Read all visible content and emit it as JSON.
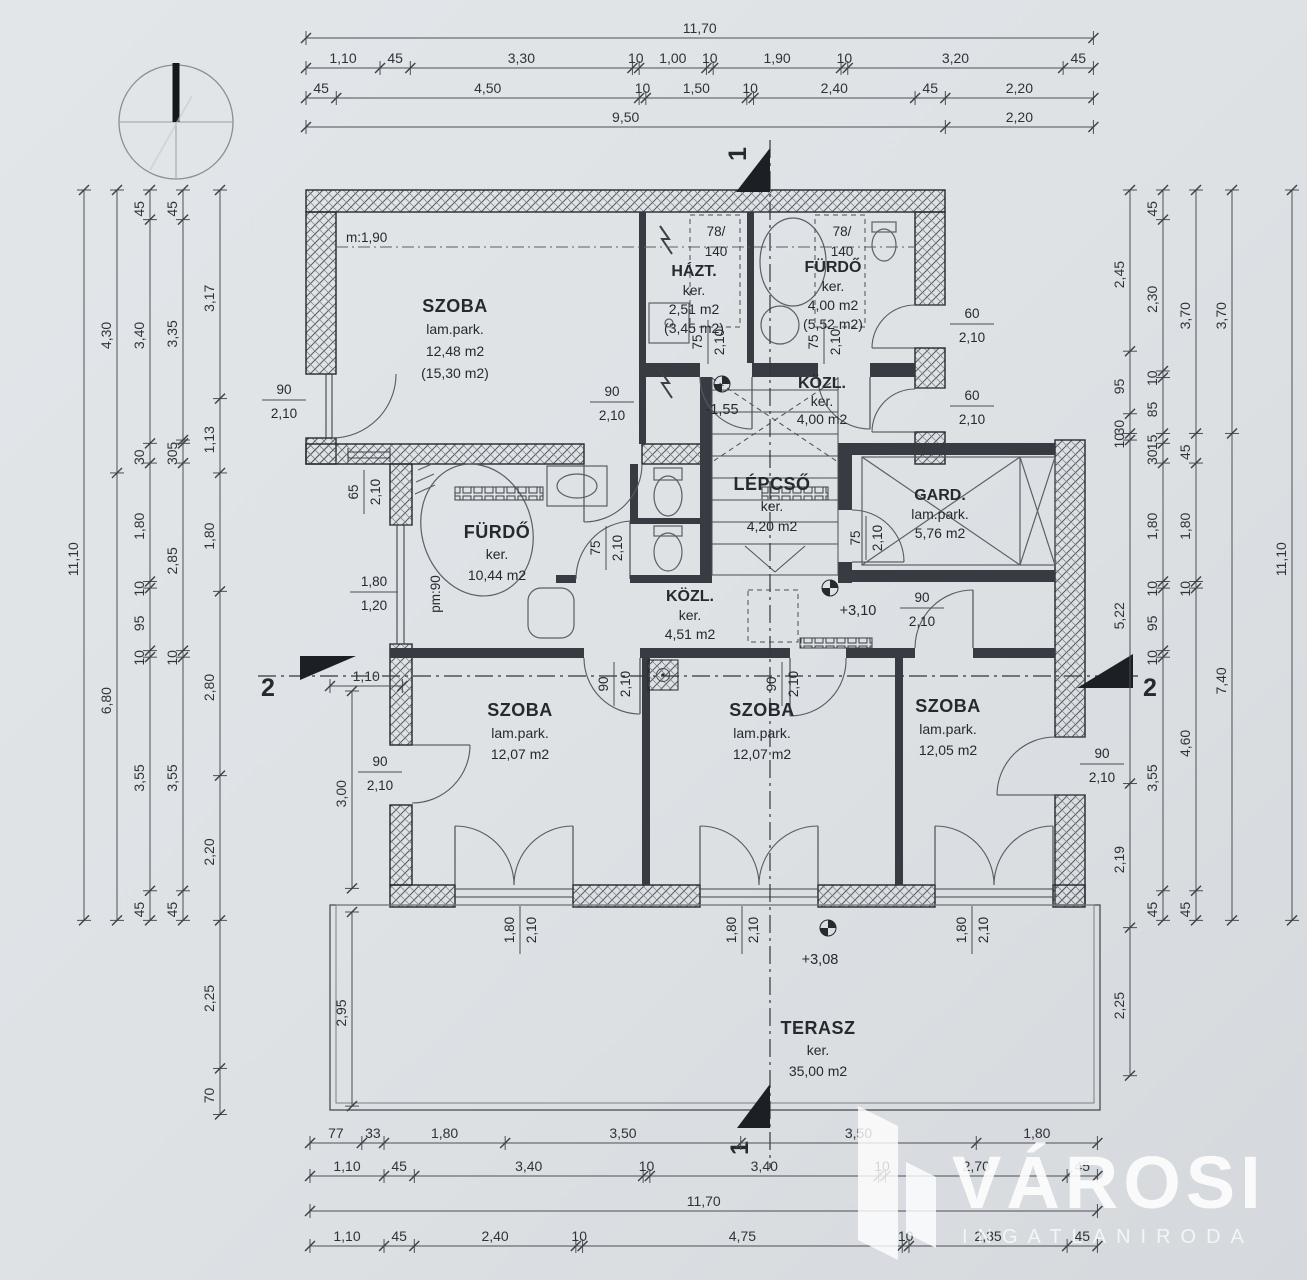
{
  "page": {
    "background": "#dde1e4",
    "line_color": "#24272b",
    "dim_color": "#4b5056",
    "watermark_color": "#ffffff"
  },
  "icons": {
    "compass": "compass-north-icon",
    "level_marker": "level-marker-icon",
    "section_arrow": "section-arrow-icon",
    "brand_logo": "brand-logo-icon"
  },
  "rooms": [
    {
      "name": "SZOBA",
      "floor": "lam.park.",
      "area": "12,48 m2",
      "gross": "(15,30 m2)",
      "note": "m:1,90"
    },
    {
      "name": "HÁZT.",
      "floor": "ker.",
      "area": "2,51 m2",
      "gross": "(3,45 m2)"
    },
    {
      "name": "FÜRDŐ",
      "floor": "ker.",
      "area": "4,00 m2",
      "gross": "(5,52 m2)"
    },
    {
      "name": "KÖZL.",
      "floor": "ker.",
      "area": "4,00 m2",
      "level": "-1,55"
    },
    {
      "name": "FÜRDŐ",
      "floor": "ker.",
      "area": "10,44 m2",
      "note": "pm:90"
    },
    {
      "name": "LÉPCSŐ",
      "floor": "ker.",
      "area": "4,20 m2"
    },
    {
      "name": "GARD.",
      "floor": "lam.park.",
      "area": "5,76 m2"
    },
    {
      "name": "KÖZL.",
      "floor": "ker.",
      "area": "4,51 m2",
      "level": "+3,10"
    },
    {
      "name": "SZOBA",
      "floor": "lam.park.",
      "area": "12,07 m2"
    },
    {
      "name": "SZOBA",
      "floor": "lam.park.",
      "area": "12,07 m2"
    },
    {
      "name": "SZOBA",
      "floor": "lam.park.",
      "area": "12,05 m2"
    },
    {
      "name": "TERASZ",
      "floor": "ker.",
      "area": "35,00 m2",
      "level": "+3,08"
    }
  ],
  "openings": [
    {
      "w": "90",
      "h": "2,10"
    },
    {
      "w": "90",
      "h": "2,10"
    },
    {
      "w": "75",
      "h": "2,10"
    },
    {
      "w": "75",
      "h": "2,10"
    },
    {
      "w": "60",
      "h": "2,10"
    },
    {
      "w": "60",
      "h": "2,10"
    },
    {
      "w": "78/",
      "h": "140"
    },
    {
      "w": "78/",
      "h": "140"
    },
    {
      "w": "65",
      "h": "2,10"
    },
    {
      "w": "1,80",
      "h": "1,20"
    },
    {
      "w": "75",
      "h": "2,10"
    },
    {
      "w": "75",
      "h": "2,10"
    },
    {
      "w": "90",
      "h": "2,10"
    },
    {
      "w": "90",
      "h": "2,10"
    },
    {
      "w": "90",
      "h": "2,10"
    },
    {
      "w": "90",
      "h": "2,10"
    },
    {
      "w": "90",
      "h": "2,10"
    },
    {
      "w": "1,80",
      "h": "2,10"
    },
    {
      "w": "1,80",
      "h": "2,10"
    },
    {
      "w": "1,80",
      "h": "2,10"
    }
  ],
  "sections": {
    "one": "1",
    "two": "2"
  },
  "dims": {
    "top": [
      [
        "11,70"
      ],
      [
        "1,10",
        "45",
        "3,30",
        "10",
        "1,00",
        "10",
        "1,90",
        "10",
        "3,20",
        "45"
      ],
      [
        "45",
        "4,50",
        "10",
        "1,50",
        "10",
        "2,40",
        "45",
        "2,20"
      ],
      [
        "9,50",
        "2,20"
      ]
    ],
    "bottom": [
      [
        "77",
        "33",
        "1,80",
        "3,50",
        "3,50",
        "1,80"
      ],
      [
        "1,10",
        "45",
        "3,40",
        "10",
        "3,40",
        "10",
        "2,70",
        "45"
      ],
      [
        "11,70"
      ],
      [
        "1,10",
        "45",
        "2,40",
        "10",
        "4,75",
        "10",
        "2,35",
        "45"
      ]
    ],
    "left": [
      [
        "11,10"
      ],
      [
        "4,30",
        "6,80"
      ],
      [
        "45",
        "3,40",
        "30",
        "1,80",
        "10",
        "95",
        "10",
        "3,55",
        "45"
      ],
      [
        "45",
        "3,35",
        "5",
        "30",
        "2,85",
        "10",
        "3,55",
        "45"
      ],
      [
        "3,17",
        "1,13",
        "1,80",
        "2,80",
        "2,20",
        "2,25",
        "70"
      ]
    ],
    "right": [
      [
        "2,45",
        "95",
        "30",
        "10",
        "5,22",
        "2,19",
        "2,25"
      ],
      [
        "45",
        "2,30",
        "10",
        "85",
        "15",
        "30",
        "1,80",
        "10",
        "95",
        "10",
        "3,55",
        "45"
      ],
      [
        "3,70",
        "45",
        "1,80",
        "10",
        "4,60",
        "45"
      ],
      [
        "3,70",
        "7,40"
      ],
      [
        "11,10"
      ]
    ],
    "inner": [
      [
        "1,10"
      ],
      [
        "3,00"
      ],
      [
        "2,95"
      ]
    ]
  },
  "watermark": {
    "brand": "VÁROSI",
    "subtitle": "INGATLANIRODA"
  }
}
